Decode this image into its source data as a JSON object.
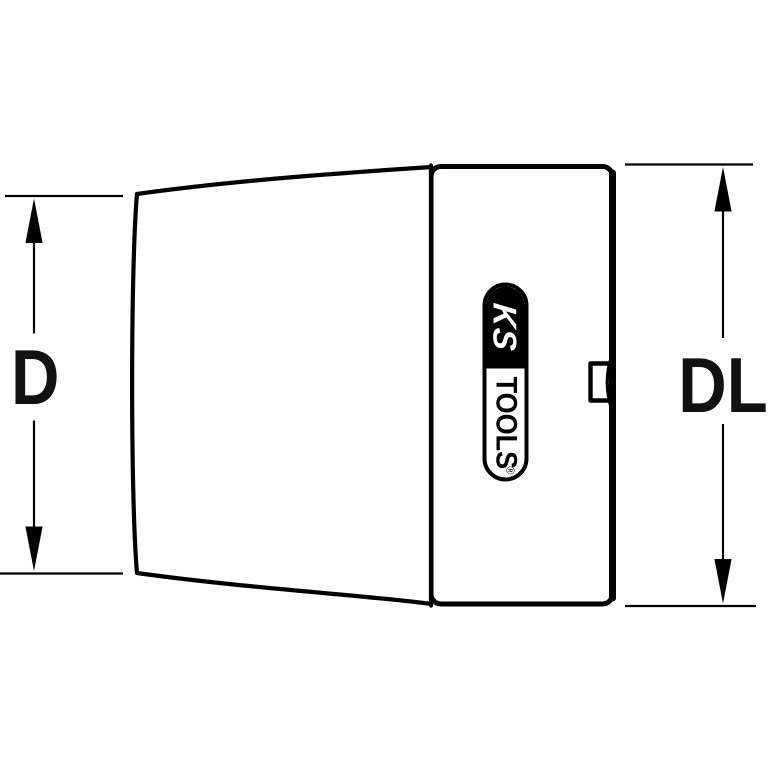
{
  "diagram": {
    "type": "technical-drawing",
    "subject": "socket-side-view",
    "dimensions": {
      "left_label": "D",
      "right_label": "DL"
    },
    "logo": {
      "brand_top": "KS",
      "brand_bottom": "TOOLS",
      "registered_mark": "®"
    }
  },
  "colors": {
    "background": "#ffffff",
    "line": "#000000",
    "label_text": "#111111",
    "logo_background": "#000000",
    "logo_text_on_black": "#ffffff"
  }
}
